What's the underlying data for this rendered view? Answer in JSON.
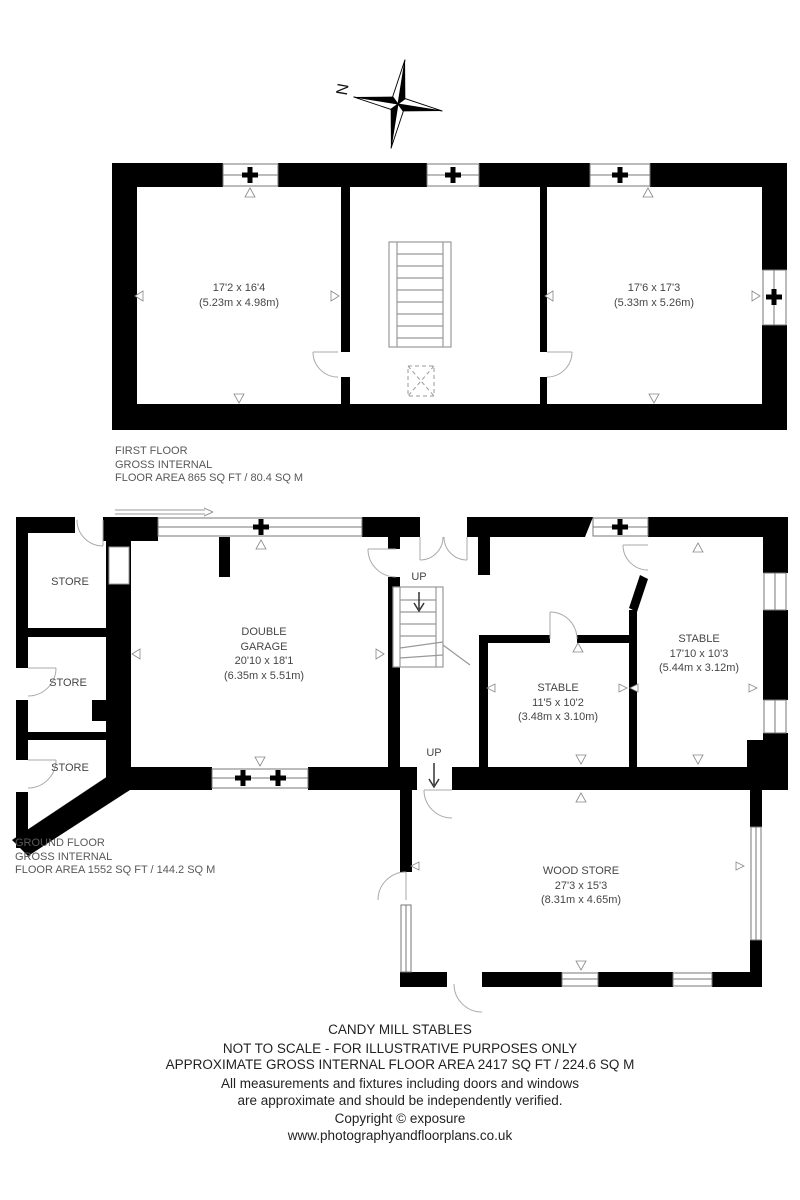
{
  "compass": {
    "north_label": "N"
  },
  "first_floor": {
    "rooms": [
      {
        "dims_ft": "17'2 x 16'4",
        "dims_m": "(5.23m x 4.98m)"
      },
      {
        "dims_ft": "17'6 x 17'3",
        "dims_m": "(5.33m x 5.26m)"
      }
    ],
    "label": {
      "line1": "FIRST FLOOR",
      "line2": "GROSS INTERNAL",
      "line3": "FLOOR AREA 865 SQ FT / 80.4 SQ M"
    }
  },
  "ground_floor": {
    "stores": [
      "STORE",
      "STORE",
      "STORE"
    ],
    "garage": {
      "name1": "DOUBLE",
      "name2": "GARAGE",
      "dims_ft": "20'10 x 18'1",
      "dims_m": "(6.35m x 5.51m)"
    },
    "stable_small": {
      "name": "STABLE",
      "dims_ft": "11'5 x 10'2",
      "dims_m": "(3.48m x 3.10m)"
    },
    "stable_large": {
      "name": "STABLE",
      "dims_ft": "17'10 x 10'3",
      "dims_m": "(5.44m x 3.12m)"
    },
    "wood_store": {
      "name": "WOOD STORE",
      "dims_ft": "27'3 x 15'3",
      "dims_m": "(8.31m x 4.65m)"
    },
    "up_labels": [
      "UP",
      "UP"
    ],
    "label": {
      "line1": "GROUND FLOOR",
      "line2": "GROSS INTERNAL",
      "line3": "FLOOR AREA 1552 SQ FT / 144.2 SQ M"
    }
  },
  "footer": {
    "title": "CANDY MILL STABLES",
    "line2": "NOT TO SCALE - FOR ILLUSTRATIVE PURPOSES ONLY",
    "line3": "APPROXIMATE GROSS INTERNAL FLOOR AREA 2417 SQ FT / 224.6 SQ M",
    "line4": "All measurements and fixtures including doors and windows",
    "line5": "are approximate and should be independently verified.",
    "line6": "Copyright © exposure",
    "line7": "www.photographyandfloorplans.co.uk"
  },
  "colors": {
    "wall": "#000000",
    "thin_line": "#777777",
    "arc": "#aaaaaa",
    "text": "#464646"
  }
}
